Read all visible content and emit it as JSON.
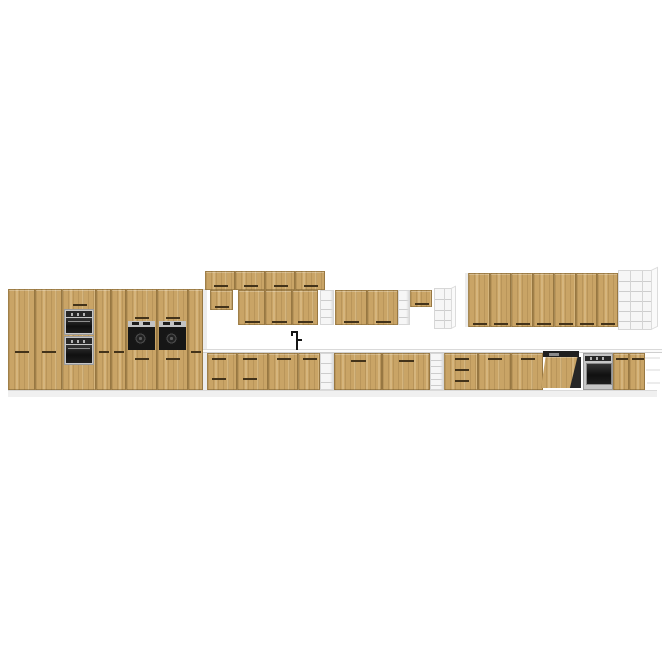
{
  "image": {
    "description": "3D product render of a long modular oak kitchen cabinet set on a white background",
    "canvas": {
      "width": 665,
      "height": 665
    }
  },
  "palette": {
    "background": "#ffffff",
    "wood": "#c9a466",
    "woodEdge": "#6d5124",
    "groove": "#43331a",
    "carcass": "#ececec",
    "carcassLine": "#d9d9d9",
    "shelfBg": "#f6f6f6",
    "shelfLine": "#cdcdcd",
    "counter": "#fbfbfb",
    "counterEdge": "#cfcfcf",
    "plinth": "#f0f0f0",
    "plinthEdge": "#dadada",
    "steel": "#c6c6c6",
    "steelDark": "#9a9a9a",
    "glass": "#181818",
    "applianceDark": "#242424",
    "faucet": "#161616"
  },
  "scene": {
    "elements": [
      {
        "n": "plinth",
        "t": "rect",
        "x": 8,
        "y": 390,
        "w": 649,
        "h": 7,
        "f": "plinth",
        "btc": "plinthEdge"
      },
      {
        "n": "tall-cabinet-door",
        "t": "wood",
        "x": 8,
        "y": 289,
        "w": 27,
        "h": 101,
        "g": [
          [
            6,
            61,
            14
          ]
        ]
      },
      {
        "n": "tall-cabinet-door",
        "t": "wood",
        "x": 35,
        "y": 289,
        "w": 27,
        "h": 101,
        "g": [
          [
            6,
            61,
            14
          ]
        ]
      },
      {
        "n": "oven-tower-cabinet",
        "t": "wood",
        "x": 62,
        "y": 289,
        "w": 34,
        "h": 101,
        "g": [
          [
            10,
            14,
            14
          ]
        ]
      },
      {
        "n": "microwave-oven",
        "t": "micro",
        "x": 64,
        "y": 309,
        "w": 30,
        "h": 26
      },
      {
        "n": "tower-built-in-oven",
        "t": "ovenface",
        "x": 64,
        "y": 336,
        "w": 30,
        "h": 29
      },
      {
        "n": "tall-cabinet-door",
        "t": "wood",
        "x": 96,
        "y": 289,
        "w": 15,
        "h": 101,
        "g": [
          [
            2,
            61,
            10
          ]
        ]
      },
      {
        "n": "tall-cabinet-door",
        "t": "wood",
        "x": 111,
        "y": 289,
        "w": 15,
        "h": 101,
        "g": [
          [
            2,
            61,
            10
          ]
        ]
      },
      {
        "n": "compact-oven-cabinet",
        "t": "wood",
        "x": 126,
        "y": 289,
        "w": 31,
        "h": 101,
        "g": [
          [
            8,
            27,
            14
          ],
          [
            8,
            68,
            14
          ]
        ]
      },
      {
        "n": "compact-oven",
        "t": "compact",
        "x": 128,
        "y": 321,
        "w": 27,
        "h": 31
      },
      {
        "n": "compact-oven-cabinet",
        "t": "wood",
        "x": 157,
        "y": 289,
        "w": 31,
        "h": 101,
        "g": [
          [
            8,
            27,
            14
          ],
          [
            8,
            68,
            14
          ]
        ]
      },
      {
        "n": "compact-oven",
        "t": "compact",
        "x": 159,
        "y": 321,
        "w": 27,
        "h": 31
      },
      {
        "n": "tall-cabinet-door",
        "t": "wood",
        "x": 188,
        "y": 289,
        "w": 15,
        "h": 101,
        "g": [
          [
            2,
            61,
            10
          ]
        ]
      },
      {
        "n": "tall-run-side-panel",
        "t": "rect",
        "x": 203,
        "y": 289,
        "w": 4,
        "h": 101,
        "f": "carcass",
        "btc": "carcassLine"
      },
      {
        "n": "top-wall-cabinet-door",
        "t": "wood",
        "x": 205,
        "y": 271,
        "w": 30,
        "h": 19,
        "g": [
          [
            8,
            13,
            14
          ]
        ]
      },
      {
        "n": "top-wall-cabinet-door",
        "t": "wood",
        "x": 235,
        "y": 271,
        "w": 30,
        "h": 19,
        "g": [
          [
            8,
            13,
            14
          ]
        ]
      },
      {
        "n": "top-wall-cabinet-door",
        "t": "wood",
        "x": 265,
        "y": 271,
        "w": 30,
        "h": 19,
        "g": [
          [
            8,
            13,
            14
          ]
        ]
      },
      {
        "n": "top-wall-cabinet-door",
        "t": "wood",
        "x": 295,
        "y": 271,
        "w": 30,
        "h": 19,
        "g": [
          [
            8,
            13,
            14
          ]
        ]
      },
      {
        "n": "wall-cabinet-short",
        "t": "wood",
        "x": 210,
        "y": 290,
        "w": 23,
        "h": 20,
        "g": [
          [
            4,
            15,
            14
          ]
        ]
      },
      {
        "n": "wall-cabinet-door",
        "t": "wood",
        "x": 238,
        "y": 290,
        "w": 27,
        "h": 35,
        "g": [
          [
            6,
            30,
            15
          ]
        ]
      },
      {
        "n": "wall-cabinet-door",
        "t": "wood",
        "x": 265,
        "y": 290,
        "w": 27,
        "h": 35,
        "g": [
          [
            6,
            30,
            15
          ]
        ]
      },
      {
        "n": "wall-cabinet-door",
        "t": "wood",
        "x": 292,
        "y": 290,
        "w": 26,
        "h": 35,
        "g": [
          [
            5,
            30,
            15
          ]
        ]
      },
      {
        "n": "open-shelf-column",
        "t": "shelf",
        "x": 320,
        "y": 290,
        "w": 14,
        "h": 35,
        "r": 3
      },
      {
        "n": "wall-cabinet-door",
        "t": "wood",
        "x": 335,
        "y": 290,
        "w": 32,
        "h": 35,
        "g": [
          [
            8,
            30,
            15
          ]
        ]
      },
      {
        "n": "wall-cabinet-door",
        "t": "wood",
        "x": 367,
        "y": 290,
        "w": 31,
        "h": 35,
        "g": [
          [
            8,
            30,
            15
          ]
        ]
      },
      {
        "n": "open-shelf-column",
        "t": "shelf",
        "x": 398,
        "y": 290,
        "w": 12,
        "h": 35,
        "r": 3
      },
      {
        "n": "wall-cabinet-half-height",
        "t": "wood",
        "x": 410,
        "y": 290,
        "w": 22,
        "h": 17,
        "g": [
          [
            4,
            12,
            14
          ]
        ]
      },
      {
        "n": "open-shelf-end-unit",
        "t": "book",
        "x": 434,
        "y": 288,
        "w": 18,
        "h": 41,
        "r": 3,
        "c": 1,
        "fl": 5
      },
      {
        "n": "wall-run-edge-panel",
        "t": "rect",
        "x": 465,
        "y": 273,
        "w": 3,
        "h": 54,
        "f": "carcass"
      },
      {
        "n": "wall-cabinet-door",
        "t": "wood",
        "x": 468,
        "y": 273,
        "w": 22,
        "h": 54,
        "g": [
          [
            4,
            49,
            14
          ]
        ]
      },
      {
        "n": "wall-cabinet-door",
        "t": "wood",
        "x": 490,
        "y": 273,
        "w": 21,
        "h": 54,
        "g": [
          [
            3,
            49,
            14
          ]
        ]
      },
      {
        "n": "wall-cabinet-door",
        "t": "wood",
        "x": 511,
        "y": 273,
        "w": 22,
        "h": 54,
        "g": [
          [
            4,
            49,
            14
          ]
        ]
      },
      {
        "n": "wall-cabinet-door",
        "t": "wood",
        "x": 533,
        "y": 273,
        "w": 21,
        "h": 54,
        "g": [
          [
            3,
            49,
            14
          ]
        ]
      },
      {
        "n": "wall-cabinet-door",
        "t": "wood",
        "x": 554,
        "y": 273,
        "w": 22,
        "h": 54,
        "g": [
          [
            4,
            49,
            14
          ]
        ]
      },
      {
        "n": "wall-cabinet-door",
        "t": "wood",
        "x": 576,
        "y": 273,
        "w": 21,
        "h": 54,
        "g": [
          [
            3,
            49,
            14
          ]
        ]
      },
      {
        "n": "wall-cabinet-door",
        "t": "wood",
        "x": 597,
        "y": 273,
        "w": 21,
        "h": 54,
        "g": [
          [
            3,
            49,
            14
          ]
        ]
      },
      {
        "n": "bookshelf-end-unit",
        "t": "book",
        "x": 618,
        "y": 270,
        "w": 34,
        "h": 60,
        "r": 5,
        "c": 2,
        "fl": 7
      },
      {
        "n": "countertop",
        "t": "rect",
        "x": 203,
        "y": 349,
        "w": 459,
        "h": 4,
        "f": "counter",
        "btc": "carcassLine",
        "bbc": "counterEdge"
      },
      {
        "n": "faucet",
        "t": "faucet",
        "x": 291,
        "y": 331,
        "w": 12,
        "h": 20
      },
      {
        "n": "base-drawer-unit",
        "t": "wood",
        "x": 207,
        "y": 353,
        "w": 30,
        "h": 37,
        "g": [
          [
            4,
            4,
            14
          ],
          [
            4,
            24,
            14
          ]
        ]
      },
      {
        "n": "base-drawer-unit",
        "t": "wood",
        "x": 237,
        "y": 353,
        "w": 31,
        "h": 37,
        "g": [
          [
            5,
            4,
            14
          ],
          [
            5,
            24,
            14
          ]
        ]
      },
      {
        "n": "base-cabinet-door",
        "t": "wood",
        "x": 268,
        "y": 353,
        "w": 30,
        "h": 37,
        "g": [
          [
            8,
            4,
            14
          ]
        ]
      },
      {
        "n": "sink-base-unit",
        "t": "wood",
        "x": 298,
        "y": 353,
        "w": 22,
        "h": 37,
        "g": [
          [
            4,
            4,
            14
          ]
        ]
      },
      {
        "n": "open-shelf-column",
        "t": "shelf",
        "x": 320,
        "y": 353,
        "w": 14,
        "h": 37,
        "r": 3
      },
      {
        "n": "base-cabinet-door-wide",
        "t": "wood",
        "x": 334,
        "y": 353,
        "w": 48,
        "h": 37,
        "g": [
          [
            16,
            6,
            15
          ]
        ]
      },
      {
        "n": "base-cabinet-door-wide",
        "t": "wood",
        "x": 382,
        "y": 353,
        "w": 48,
        "h": 37,
        "g": [
          [
            16,
            6,
            15
          ]
        ]
      },
      {
        "n": "open-shelf-column",
        "t": "shelf",
        "x": 430,
        "y": 353,
        "w": 14,
        "h": 37,
        "r": 5
      },
      {
        "n": "base-drawer-stack",
        "t": "wood",
        "x": 444,
        "y": 353,
        "w": 34,
        "h": 37,
        "g": [
          [
            10,
            4,
            14
          ],
          [
            10,
            15,
            14
          ],
          [
            10,
            26,
            14
          ]
        ]
      },
      {
        "n": "base-cabinet-door",
        "t": "wood",
        "x": 478,
        "y": 353,
        "w": 33,
        "h": 37,
        "g": [
          [
            9,
            4,
            14
          ]
        ]
      },
      {
        "n": "base-cabinet-door",
        "t": "wood",
        "x": 511,
        "y": 353,
        "w": 32,
        "h": 37,
        "g": [
          [
            9,
            4,
            14
          ]
        ]
      },
      {
        "n": "dishwasher-open-door",
        "t": "dw",
        "x": 541,
        "y": 351,
        "w": 42,
        "h": 39
      },
      {
        "n": "built-in-oven",
        "t": "bio",
        "x": 583,
        "y": 353,
        "w": 30,
        "h": 37
      },
      {
        "n": "base-cabinet-door",
        "t": "wood",
        "x": 613,
        "y": 353,
        "w": 16,
        "h": 37,
        "g": [
          [
            2,
            4,
            12
          ]
        ]
      },
      {
        "n": "base-cabinet-door",
        "t": "wood",
        "x": 629,
        "y": 353,
        "w": 16,
        "h": 37,
        "g": [
          [
            2,
            4,
            12
          ]
        ]
      },
      {
        "n": "end-shelf-ledge",
        "t": "rect",
        "x": 645,
        "y": 357,
        "w": 15,
        "h": 2,
        "f": "carcass"
      },
      {
        "n": "end-shelf-ledge",
        "t": "rect",
        "x": 646,
        "y": 369,
        "w": 14,
        "h": 2,
        "f": "carcass"
      },
      {
        "n": "end-shelf-ledge",
        "t": "rect",
        "x": 647,
        "y": 382,
        "w": 13,
        "h": 2,
        "f": "carcass"
      }
    ]
  }
}
